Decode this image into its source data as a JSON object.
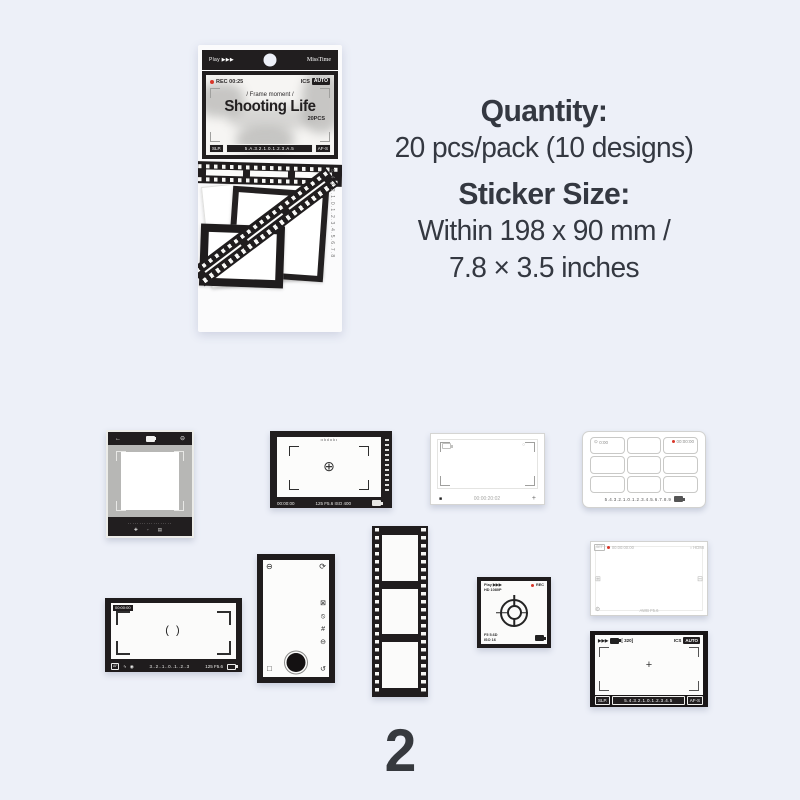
{
  "page": {
    "number": "2",
    "background": "#edf0f8"
  },
  "info": {
    "quantity_label": "Quantity:",
    "quantity_value": "20 pcs/pack (10 designs)",
    "size_label": "Sticker Size:",
    "size_line1": "Within 198 x 90 mm /",
    "size_line2": "7.8 × 3.5 inches"
  },
  "package": {
    "play": "Play ▶▶▶",
    "brand": "MissTime",
    "rec_label": "REC  00:25",
    "ics": "ICS",
    "auto": "AUTO",
    "tagline": "/ Frame moment /",
    "title": "Shooting Life",
    "pcs": "20PCS",
    "slp": "SLP.",
    "ev_scale": "5.A.3.2.1.0.1.2.3.A.5",
    "afs": "AF-S",
    "side_ruler": "5.4.3.2.1.0.1.2.3.4.5.6.7.8"
  },
  "stickers": {
    "instax": {
      "back_icon": "←",
      "timer_icon": "⊖",
      "ruler_dots": "···················",
      "foot_icons": "✚ ◦ ▤"
    },
    "viewfinder_s": {
      "top_ruler": "ıılıılıılıı",
      "focus_icon": "⊕",
      "timecode": "00:00:00",
      "exposure": "125 F5.6 ISO 400"
    },
    "photo_frame": {
      "shutter_icon": "■",
      "timecode": "00:00:20:02",
      "plus_icon": "+",
      "lens_icon": "○"
    },
    "grid_sheet": {
      "clock_icon": "⊙",
      "clock": "0:00",
      "rec": "00:00:00",
      "ruler": "5.4.3.2.1.0.1.2.3.4.5.6.7.8.9"
    },
    "viewfinder_l": {
      "rec_box": "00:00:00",
      "af": "AF",
      "flash_icon": "ϟ",
      "face_icon": "◉",
      "ev_scale": "3..2..1..0..1..2..3",
      "exposure": "125 F5.6",
      "focus_marks": "(  )"
    },
    "camera_back": {
      "timer_icon": "⊖",
      "rotate_icon": "⟳",
      "col_icons": [
        "⊠",
        "⦸",
        "#",
        "⊖"
      ],
      "square_icon": "□",
      "flip_icon": "↺"
    },
    "rec_square": {
      "play": "Play ▶▶▶",
      "hd": "HD 1080P",
      "rec": "REC",
      "aperture": "F5 5.6D",
      "iso": "ISO 16"
    },
    "dv_frame": {
      "set": "SET",
      "timecode": "00:00:00:00",
      "hdmi": "○ HDMI",
      "left_icon": "⊞",
      "right_icon": "⊟",
      "gear_icon": "⚙",
      "awb": "AWB  F5.6"
    },
    "viewfinder_pkg": {
      "play": "▶▶▶",
      "frames": "[ 320]",
      "ics": "ICS",
      "auto": "AUTO",
      "plus_icon": "+",
      "slp": "SLP.",
      "ev_scale": "5.4.3.2.1.0.1.2.3.4.5",
      "afs": "AF-S"
    }
  }
}
